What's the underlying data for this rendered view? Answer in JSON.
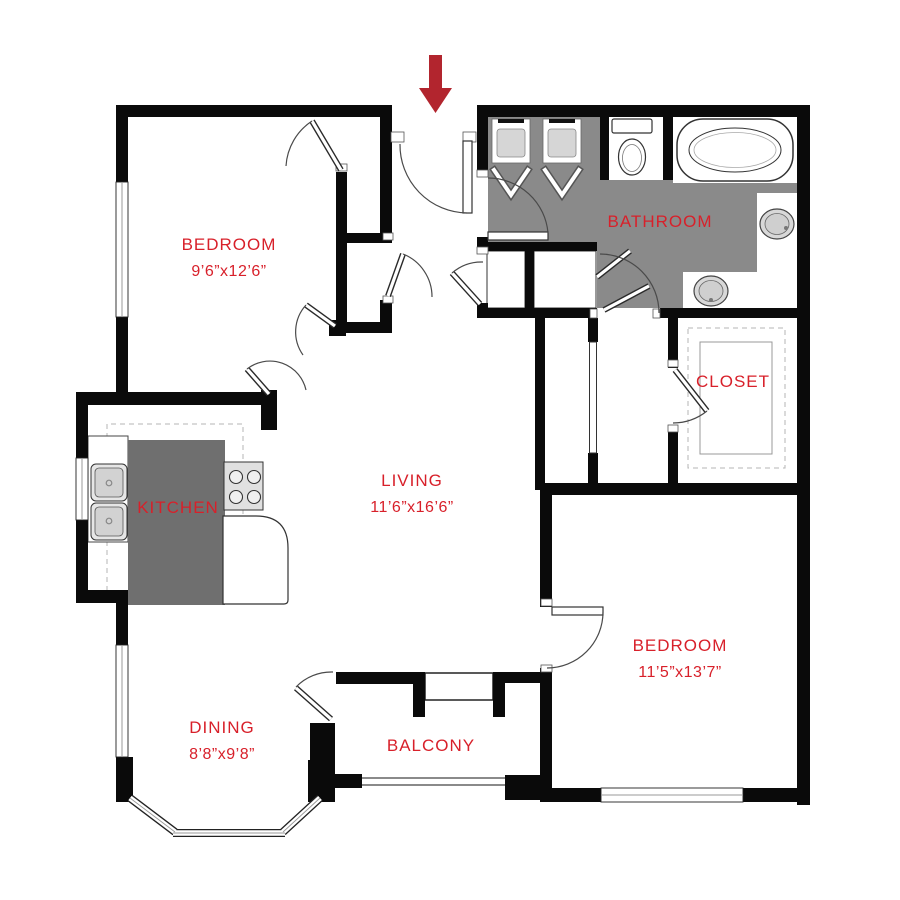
{
  "rooms": {
    "bedroom1": {
      "name": "BEDROOM",
      "dims": "9’6”x12’6”"
    },
    "bathroom": {
      "name": "BATHROOM"
    },
    "closet": {
      "name": "CLOSET"
    },
    "living": {
      "name": "LIVING",
      "dims": "11’6”x16’6”"
    },
    "kitchen": {
      "name": "KITCHEN"
    },
    "bedroom2": {
      "name": "BEDROOM",
      "dims": "11’5”x13’7”"
    },
    "dining": {
      "name": "DINING",
      "dims": "8’8”x9’8”"
    },
    "balcony": {
      "name": "BALCONY"
    }
  },
  "entry": {
    "symbol": "entry-arrow",
    "direction": "down",
    "color": "#b2252e"
  },
  "fixtures": [
    "double-vanity-sinks",
    "toilet",
    "bathtub",
    "round-basin",
    "round-basin",
    "washer-dryer-closets",
    "walk-in-closet-shelving",
    "kitchen-island",
    "kitchen-double-sink",
    "four-burner-stove",
    "kitchen-counter",
    "balcony-storage",
    "balcony-railing",
    "bay-window"
  ],
  "colors": {
    "label_red": "#d8202a",
    "arrow_red": "#b2252e",
    "wall_black": "#0a0a0a",
    "bathroom_floor": "#8a8a8a",
    "kitchen_island": "#6f6f6f",
    "fixture_fill": "#d8d8d8"
  }
}
